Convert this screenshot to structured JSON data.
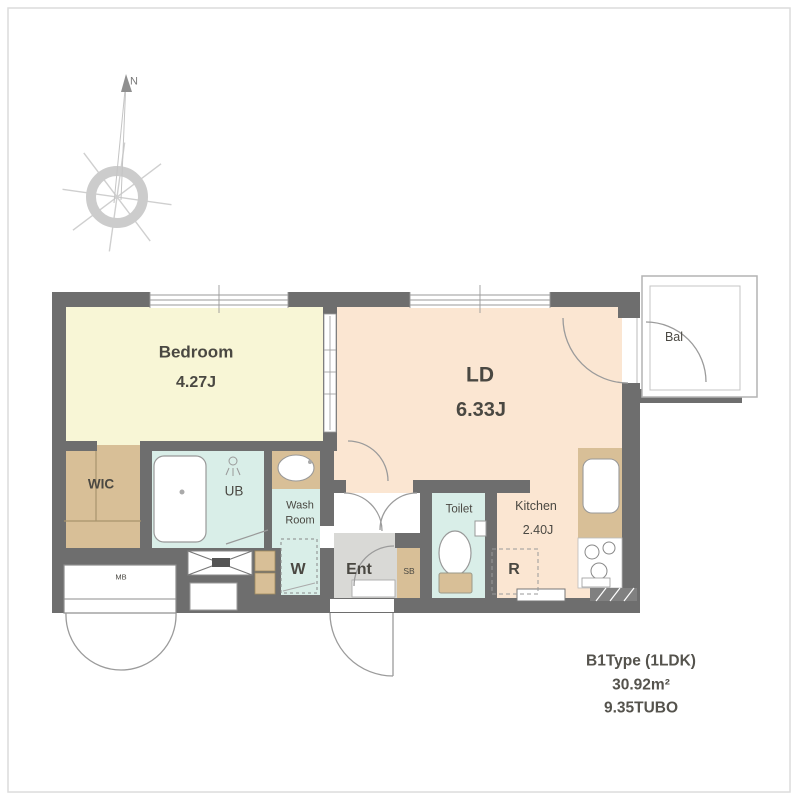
{
  "colors": {
    "wall": "#6e6e6e",
    "bedroom": "#f8f6d6",
    "living": "#fbe6d2",
    "wet": "#d9eee8",
    "tan": "#d8bf97",
    "entry": "#d9d9d6",
    "white": "#ffffff",
    "line": "#999999",
    "text": "#4a4842"
  },
  "compass": {
    "north_label": "N"
  },
  "rooms": {
    "bedroom": {
      "name": "Bedroom",
      "area": "4.27J"
    },
    "living_dining": {
      "name": "LD",
      "area": "6.33J"
    },
    "kitchen": {
      "name": "Kitchen",
      "area": "2.40J"
    },
    "balcony": {
      "name": "Bal"
    },
    "walk_in_closet": {
      "name": "WIC"
    },
    "unit_bath": {
      "name": "UB"
    },
    "washroom": {
      "line1": "Wash",
      "line2": "Room"
    },
    "washer": {
      "name": "W"
    },
    "entrance": {
      "name": "Ent"
    },
    "shoe_box": {
      "name": "SB"
    },
    "toilet": {
      "name": "Toilet"
    },
    "refrigerator": {
      "name": "R"
    },
    "meter_box": {
      "name": "MB"
    }
  },
  "plan_info": {
    "type": "B1Type (1LDK)",
    "area_sqm": "30.92m²",
    "area_tsubo": "9.35TUBO"
  }
}
